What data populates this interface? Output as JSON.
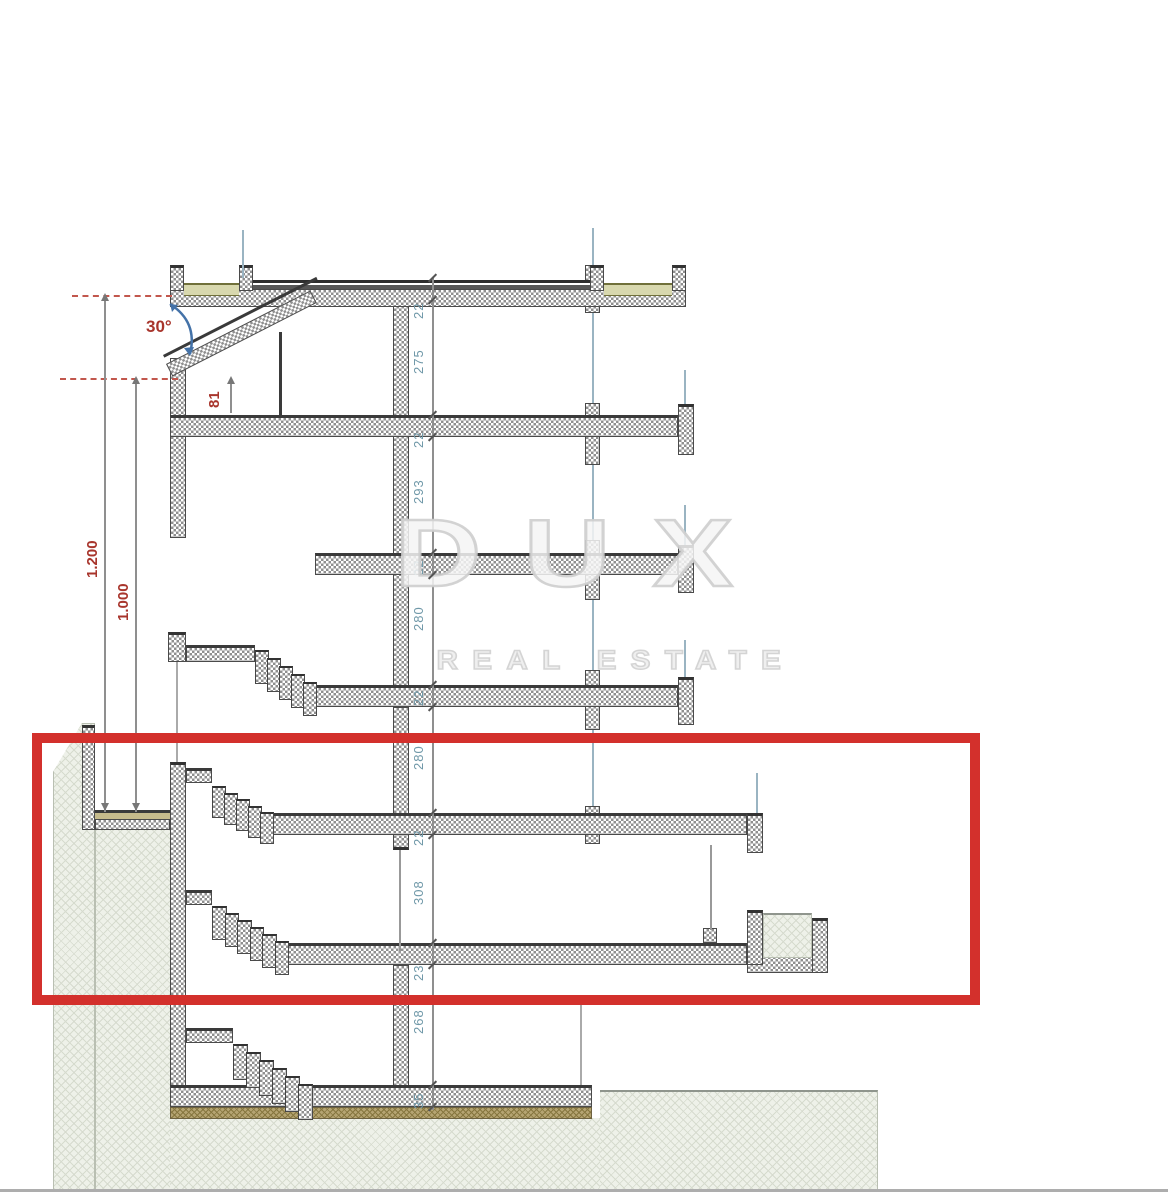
{
  "watermark": {
    "title": "DUX",
    "subtitle": "REAL ESTATE"
  },
  "annotations": {
    "roof_angle": "30°",
    "knee_wall_height": "81",
    "upper_level": "1.200",
    "lower_level": "1.000"
  },
  "dimension_chain": [
    "22",
    "275",
    "22",
    "293",
    "22",
    "280",
    "22",
    "280",
    "22",
    "308",
    "23",
    "268",
    "35"
  ],
  "colors": {
    "highlight_box": "#d3302c",
    "dimension_text": "#6f98a8",
    "annotation_text": "#a8352c",
    "angle_arrow": "#4472a8"
  }
}
